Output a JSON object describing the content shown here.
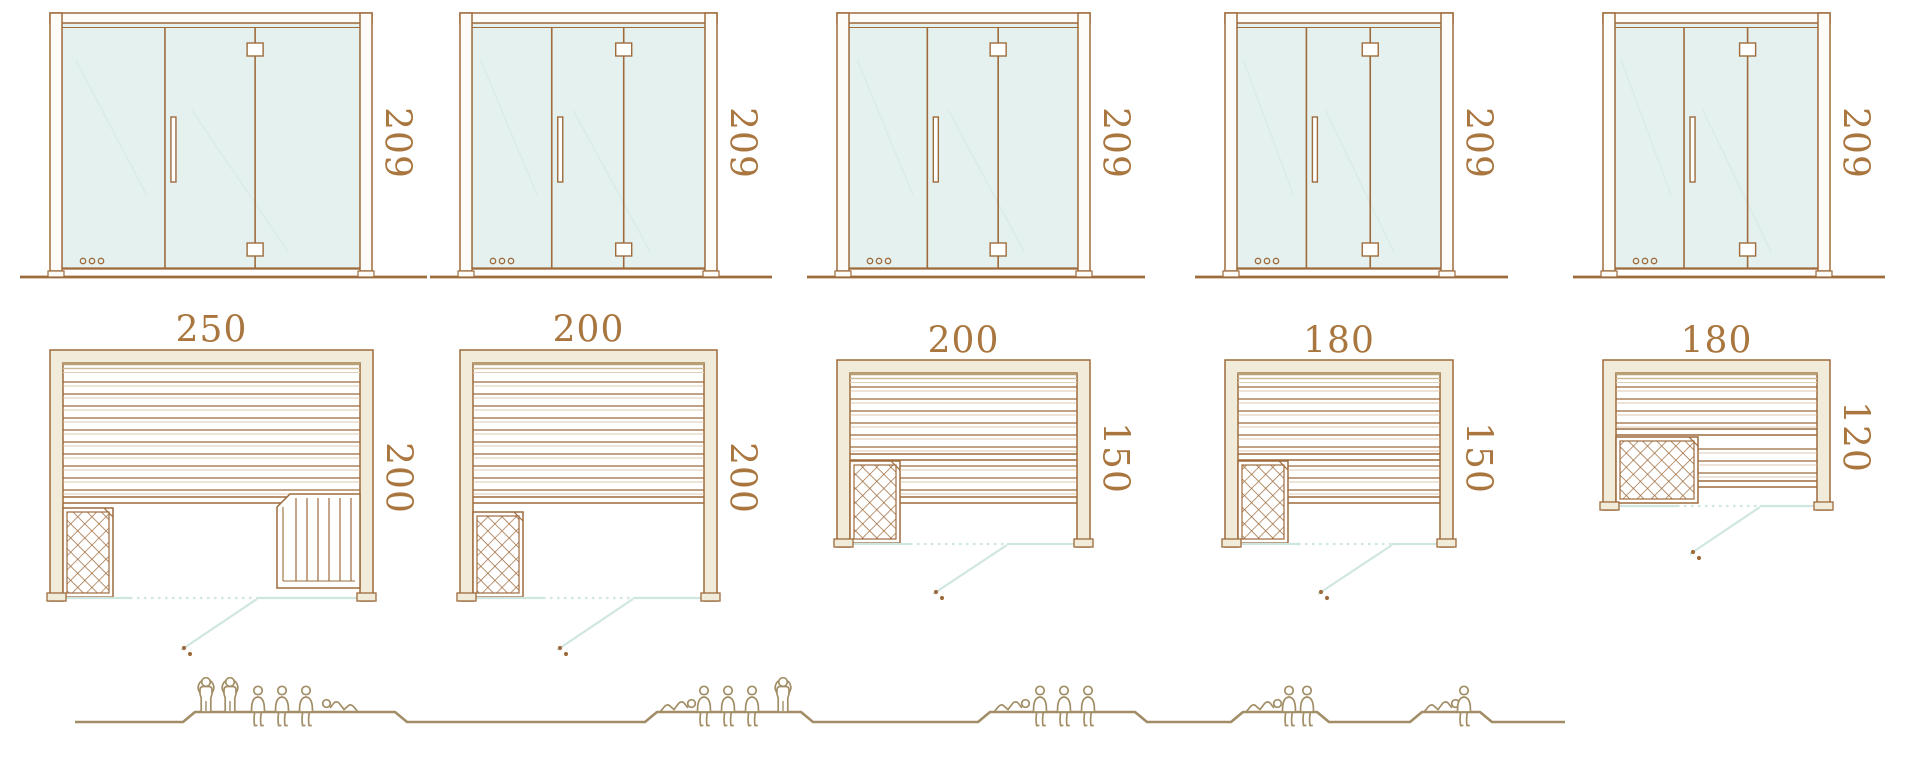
{
  "diagram": {
    "title": "sauna cabin size comparison",
    "rows": [
      "door-elevations",
      "floor-plans",
      "capacity-figures"
    ],
    "units_of_measure": "cm"
  },
  "colors": {
    "line": "#9e6b3c",
    "dim_text": "#a8763e",
    "glass": "#e4f1ee",
    "glass_reflection": "#d9ebe7",
    "front_line": "#cfe5e0",
    "door_swing": "#cfe6e1",
    "wall_fill": "#f0ecd9",
    "frame_fill": "#fdfcf8",
    "shade1": "#b99f76",
    "shade2": "#cdbb98",
    "shade3": "#ddd0b4",
    "slat_light": "#cfb591",
    "people": "#a28e66",
    "background": "#ffffff"
  },
  "units": [
    {
      "id": "sauna-250x200",
      "door": {
        "x": 50,
        "w": 322,
        "height_label": "209"
      },
      "plan": {
        "x": 50,
        "y": 350,
        "w": 323,
        "width_label": "250",
        "depth_label": "200",
        "label_y": 330,
        "side_label_y": 478,
        "feet_y": 593,
        "slats": {
          "y1": 382,
          "y2": 490,
          "pitch": 12
        },
        "bench_edge": [
          497,
          503
        ],
        "heater": {
          "x": 63,
          "y": 508,
          "w": 50,
          "h": 89
        },
        "lower_bench": null,
        "side_bench": {
          "x1": 277,
          "x2": 360,
          "y1": 494,
          "y2": 588,
          "pitch": 11
        },
        "front": {
          "y": 598,
          "x1": 63,
          "x2": 360,
          "dot1": 130,
          "dot2": 257,
          "diag": [
            [
              257,
              599
            ],
            [
              181,
              650
            ]
          ],
          "handle": [
            184,
            648
          ]
        }
      },
      "capacity": {
        "standing": 2,
        "sitting": 3,
        "lying": 1,
        "total": 6
      }
    },
    {
      "id": "sauna-200x200",
      "door": {
        "x": 460,
        "w": 257,
        "height_label": "209"
      },
      "plan": {
        "x": 460,
        "y": 350,
        "w": 257,
        "width_label": "200",
        "depth_label": "200",
        "label_y": 330,
        "side_label_y": 478,
        "feet_y": 593,
        "slats": {
          "y1": 382,
          "y2": 490,
          "pitch": 12
        },
        "bench_edge": [
          497,
          503
        ],
        "heater": {
          "x": 473,
          "y": 512,
          "w": 50,
          "h": 85
        },
        "lower_bench": null,
        "side_bench": null,
        "front": {
          "y": 598,
          "x1": 473,
          "x2": 704,
          "dot1": 543,
          "dot2": 633,
          "diag": [
            [
              633,
              599
            ],
            [
              557,
              650
            ]
          ],
          "handle": [
            560,
            648
          ]
        }
      },
      "capacity": {
        "standing": 1,
        "sitting": 3,
        "lying": 1,
        "total": 5
      }
    },
    {
      "id": "sauna-200x150",
      "door": {
        "x": 837,
        "w": 253,
        "height_label": "209"
      },
      "plan": {
        "x": 837,
        "y": 360,
        "w": 253,
        "width_label": "200",
        "depth_label": "150",
        "label_y": 341,
        "side_label_y": 458,
        "feet_y": 539,
        "slats": {
          "y1": 387,
          "y2": 447,
          "pitch": 12
        },
        "bench_edge": [
          454,
          460
        ],
        "heater": {
          "x": 850,
          "y": 461,
          "w": 50,
          "h": 82
        },
        "lower_bench": {
          "x1": 900,
          "x2": 1077,
          "slats": [
            466,
            478,
            490
          ],
          "edge": [
            497,
            503
          ]
        },
        "side_bench": null,
        "front": {
          "y": 544,
          "x1": 850,
          "x2": 1077,
          "dot1": 910,
          "dot2": 1007,
          "diag": [
            [
              1007,
              545
            ],
            [
              933,
              594
            ]
          ],
          "handle": [
            936,
            592
          ]
        }
      },
      "capacity": {
        "standing": 0,
        "sitting": 3,
        "lying": 1,
        "total": 4
      }
    },
    {
      "id": "sauna-180x150",
      "door": {
        "x": 1225,
        "w": 228,
        "height_label": "209"
      },
      "plan": {
        "x": 1225,
        "y": 360,
        "w": 228,
        "width_label": "180",
        "depth_label": "150",
        "label_y": 341,
        "side_label_y": 458,
        "feet_y": 539,
        "slats": {
          "y1": 387,
          "y2": 447,
          "pitch": 12
        },
        "bench_edge": [
          454,
          460
        ],
        "heater": {
          "x": 1238,
          "y": 461,
          "w": 50,
          "h": 82
        },
        "lower_bench": {
          "x1": 1288,
          "x2": 1440,
          "slats": [
            466,
            478,
            490
          ],
          "edge": [
            497,
            503
          ]
        },
        "side_bench": null,
        "front": {
          "y": 544,
          "x1": 1238,
          "x2": 1440,
          "dot1": 1298,
          "dot2": 1392,
          "diag": [
            [
              1392,
              545
            ],
            [
              1318,
              594
            ]
          ],
          "handle": [
            1321,
            592
          ]
        }
      },
      "capacity": {
        "standing": 0,
        "sitting": 2,
        "lying": 1,
        "total": 3
      }
    },
    {
      "id": "sauna-180x120",
      "door": {
        "x": 1603,
        "w": 227,
        "height_label": "209"
      },
      "plan": {
        "x": 1603,
        "y": 360,
        "w": 227,
        "width_label": "180",
        "depth_label": "120",
        "label_y": 341,
        "side_label_y": 437,
        "feet_y": 502,
        "slats": {
          "y1": 387,
          "y2": 423,
          "pitch": 12
        },
        "bench_edge": [
          429,
          435
        ],
        "heater": {
          "x": 1616,
          "y": 437,
          "w": 82,
          "h": 66
        },
        "lower_bench": {
          "x1": 1698,
          "x2": 1817,
          "slats": [
            449,
            461,
            473
          ],
          "edge": [
            481,
            487
          ]
        },
        "side_bench": null,
        "front": {
          "y": 506,
          "x1": 1616,
          "x2": 1817,
          "dot1": 1677,
          "dot2": 1760,
          "diag": [
            [
              1760,
              507
            ],
            [
              1690,
              554
            ]
          ],
          "handle": [
            1693,
            552
          ]
        }
      },
      "capacity": {
        "standing": 0,
        "sitting": 1,
        "lying": 1,
        "total": 2
      }
    }
  ],
  "ground": {
    "y_base": 722,
    "y_platform": 712,
    "ramp": 12,
    "x_start": 75,
    "x_end": 1565,
    "groups": [
      {
        "span": [
          195,
          395
        ],
        "figures": [
          {
            "t": "standing",
            "x": 206
          },
          {
            "t": "standing",
            "x": 230
          },
          {
            "t": "sitting",
            "x": 258
          },
          {
            "t": "sitting",
            "x": 282
          },
          {
            "t": "sitting",
            "x": 306
          },
          {
            "t": "lying",
            "x": 322,
            "dir": "hl"
          }
        ]
      },
      {
        "span": [
          657,
          801
        ],
        "figures": [
          {
            "t": "lying",
            "x": 660,
            "dir": "hr"
          },
          {
            "t": "sitting",
            "x": 704
          },
          {
            "t": "sitting",
            "x": 728
          },
          {
            "t": "sitting",
            "x": 752
          },
          {
            "t": "standing",
            "x": 783
          }
        ]
      },
      {
        "span": [
          990,
          1135
        ],
        "figures": [
          {
            "t": "lying",
            "x": 994,
            "dir": "hr"
          },
          {
            "t": "sitting",
            "x": 1040
          },
          {
            "t": "sitting",
            "x": 1064
          },
          {
            "t": "sitting",
            "x": 1088
          }
        ]
      },
      {
        "span": [
          1243,
          1317
        ],
        "figures": [
          {
            "t": "lying",
            "x": 1246,
            "dir": "hr"
          },
          {
            "t": "sitting",
            "x": 1289
          },
          {
            "t": "sitting",
            "x": 1307
          }
        ]
      },
      {
        "span": [
          1422,
          1480
        ],
        "figures": [
          {
            "t": "lying",
            "x": 1424,
            "dir": "hr"
          },
          {
            "t": "sitting",
            "x": 1464
          }
        ]
      }
    ]
  }
}
